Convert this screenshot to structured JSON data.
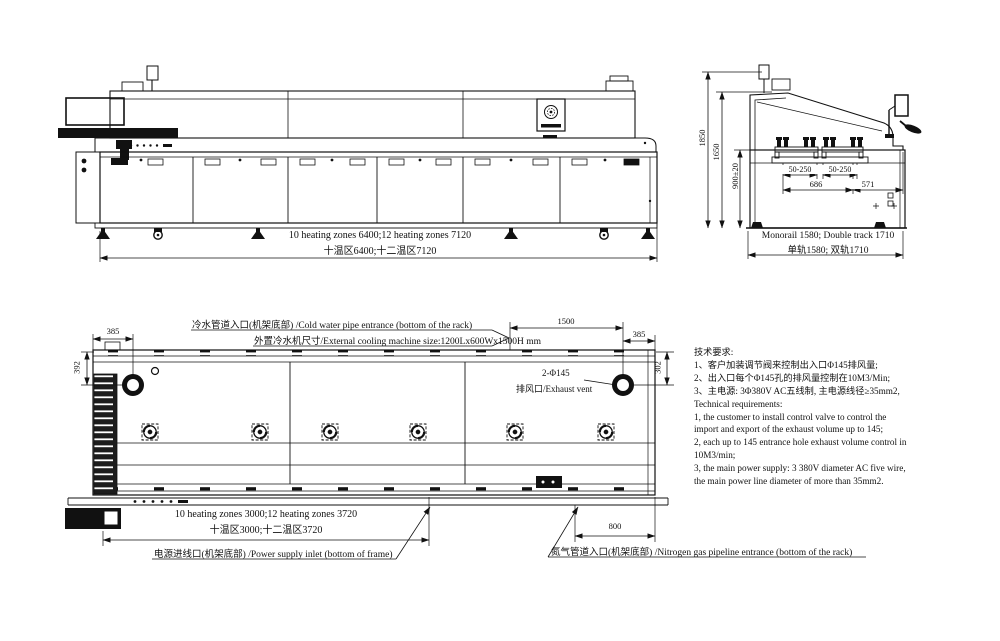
{
  "side_view": {
    "zones_en": "10 heating zones 6400;12 heating zones 7120",
    "zones_cn": "十温区6400;十二温区7120"
  },
  "end_view": {
    "dim_overall_height": "1850",
    "dim_hood_height": "1650",
    "dim_conveyor_height": "900±20",
    "dim_rail_range_left": "50-250",
    "dim_rail_range_right": "50-250",
    "dim_rail_width": "686",
    "dim_side_clearance": "571",
    "track_en": "Monorail 1580; Double track 1710",
    "track_cn": "单轨1580; 双轨1710"
  },
  "plan_view": {
    "dim_left_offset": "385",
    "dim_right_offset": "385",
    "dim_vent_span": "1500",
    "dim_left_vent_y": "392",
    "dim_right_vent_y": "302",
    "dim_nitrogen_offset": "800",
    "cold_water_label": "冷水管道入口(机架底部) /Cold water pipe entrance (bottom of the rack)",
    "cooling_machine_label": "外置冷水机尺寸/External cooling machine size:1200Lx600Wx1500H mm",
    "vent_count_label": "2-Φ145",
    "vent_label": "排风口/Exhaust vent",
    "zones_en": "10 heating zones 3000;12 heating zones 3720",
    "zones_cn": "十温区3000;十二温区3720",
    "power_label": "电源进线口(机架底部) /Power supply inlet (bottom of frame)",
    "nitrogen_label": "氮气管道入口(机架底部) /Nitrogen gas pipeline entrance (bottom of the rack)"
  },
  "tech_requirements": {
    "lines": [
      "技术要求:",
      "1、客户加装调节阀来控制出入口Φ145排风量;",
      "2、出入口每个Φ145孔的排风量控制在10M3/Min;",
      "3、主电源: 3Φ380V AC五线制, 主电源线径≥35mm2,",
      "Technical requirements:",
      "1, the customer to install control valve to control the",
      "import and export of the exhaust volume up to 145;",
      "2, each up to 145 entrance hole exhaust volume control in",
      "10M3/min;",
      "3, the main power supply: 3 380V diameter AC five wire,",
      "the main power line diameter of more than 35mm2."
    ]
  },
  "colors": {
    "ink": "#111111",
    "paper": "#ffffff"
  }
}
